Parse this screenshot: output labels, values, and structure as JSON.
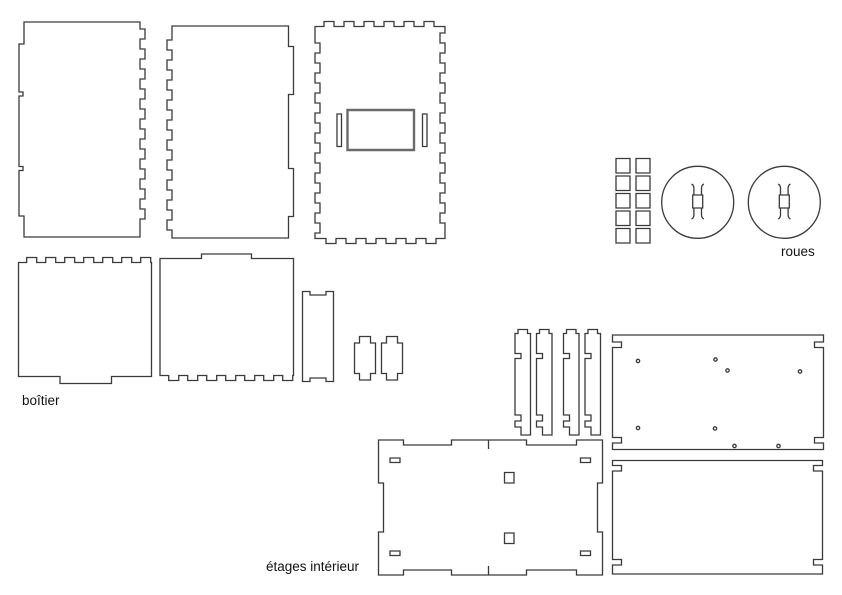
{
  "drawing": {
    "background": "#ffffff",
    "stroke_color": "#3a3a3a",
    "sections": {
      "boitier": {
        "label": "boîtier"
      },
      "roues": {
        "label": "roues"
      },
      "etages_interieur": {
        "label": "étages intérieur"
      }
    }
  },
  "parts": {
    "side_panel_a": {
      "d": "M24,22 H140 v7 h5 v10 h-5 v10 h5 v10 h-5 v10 h5 v10 h-5 v10 h5 v10 h-5 v10 h5 v10 h-5 v10 h5 v10 h-5 v10 h5 v10 h-5 v10 h5 v10 h-5 v10 h5 v10 h-5 v10 h5 v10 h-5 v10 v8 H24 v-21 h-5 v-45.5 h4 v-4 h-4 v-70.5 h4 v-4 h-4 v-48 h5 Z"
    },
    "side_panel_b": {
      "d": "M172,26 H288.5 v20.5 h5 v48 h-5 v74 h5 v48 h-5 v21.5 H172 v-8 h-5 v-10 h5 v-10 h-5 v-10 h5 v-10 h-5 v-10 h5 v-10 h-5 v-10 h5 v-10 h-5 v-10 h5 v-10 h-5 v-10 h5 v-10 h-5 v-10 h5 v-10 h-5 v-10 h5 v-10 h-5 v-10 h5 v-10 h-5 v-10 h5 v-10 v-4 Z"
    },
    "back_panel": {
      "d": "M315,26.5 h9 v-5 h10 v5 h10 v-5 h10 v5 h10 v-5 h10 v5 h10 v-5 h10 v5 h10 v-5 h10 v5 h10 v-5 h10 v5 h11 v6.5 h-5 v10 h5 v10 h-5 v10 h5 v10 h-5 v10 h5 v10 h-5 v10 h5 v10 h-5 v10 h5 v10 h-5 v10 h5 v10 h-5 v10 h5 v10 h-5 v10 h5 v10 h-5 v10 h5 v10 h-5 v10 h5 v10 v5.5 h-9 v5 h-10 v-5 h-10 v5 h-10 v-5 h-10 v5 h-10 v-5 h-10 v5 h-10 v-5 h-10 v5 h-10 v-5 h-10 v5 h-10 v-5 h-11 v-5.5 h5 v-10 h-5 v-10 h5 v-10 h-5 v-10 h5 v-10 h-5 v-10 h5 v-10 h-5 v-10 h5 v-10 h-5 v-10 h5 v-10 h-5 v-10 h5 v-10 h-5 v-10 h5 v-10 h-5 v-10 h5 v-10 h-5 v-10 h5 v-10 h-5 v-10 v-6.5 Z"
    },
    "back_panel_window": {
      "d": "M347.5,110 h66.5 v40 h-66.5 Z"
    },
    "back_panel_slots": {
      "d": "M337,114 h4.5 v32.5 h-4.5 Z M422.5,114 h4.5 v32.5 h-4.5 Z"
    },
    "spacer_squares": {
      "d": "M616,158.5 h14 v14.5 h-14 Z M636,158.5 h14 v14.5 h-14 Z M616,176 h14 v14.5 h-14 Z M636,176 h14 v14.5 h-14 Z M616,193.5 h14 v14.5 h-14 Z M636,193.5 h14 v14.5 h-14 Z M616,211 h14 v14.5 h-14 Z M636,211 h14 v14.5 h-14 Z M616,228.5 h14 v14.5 h-14 Z M636,228.5 h14 v14.5 h-14 Z"
    },
    "wheel_a": {
      "d": "M661.7,202.3 a36,36 0 1 0 72,0 a36,36 0 1 0 -72,0 M692.7,195 h10 v13 h-10 Z M693.9,195 v-7 q0,-2.6 -2.3,-4.1 M701.5,195 v-7 q0,-2.6 2.3,-4.1 M693.9,208 v7 q0,2.6 -2.3,4.1 M701.5,208 v7 q0,2.6 2.3,4.1"
    },
    "wheel_b": {
      "d": "M748.3,202.3 a36,36 0 1 0 72,0 a36,36 0 1 0 -72,0 M779.3,195 h10 v13 h-10 Z M780.5,195 v-7 q0,-2.6 -2.3,-4.1 M788.1,195 v-7 q0,-2.6 2.3,-4.1 M780.5,208 v7 q0,2.6 -2.3,4.1 M788.1,208 v7 q0,2.6 2.3,4.1"
    },
    "box_panel_a": {
      "d": "M18.5,262.5 h8.2 v-5 h10 v5 h9 v-5 h10 v5 h9 v-5 h10 v5 h9 v-5 h10 v5 h9 v-5 h10 v5 h9 v-5 h10 v5 h9 v-5 h10 v5 h0.8 V376.5 h-40 v7 h-51.5 v-7 H18.5 Z"
    },
    "box_panel_b": {
      "d": "M160,258.5 h41.5 v-4.5 h50 v4.5 h42 V375.5 h-0.8 v5 h-10 v-5 h-9 v5 h-10 v-5 h-9 v5 h-10 v-5 h-9 v5 h-10 v-5 h-9 v5 h-10 v-5 h-9 v5 h-10 v-5 h-9 v5 h-10 v-5 h-8.7 Z"
    },
    "box_panel_c": {
      "d": "M302.5,291.5 h7.5 v3.5 h16 v-3.5 h7.5 V381.5 h-7.5 v-3.5 h-16 v3.5 h-7.5 Z"
    },
    "clip_a": {
      "d": "M359.5,336.5 h11 v6.5 h5 v30.5 h-5 v6.5 h-11 v-6.5 h-5 v-30.5 h5 Z"
    },
    "clip_b": {
      "d": "M386.5,336.5 h11 v6.5 h5 v30.5 h-5 v6.5 h-11 v-6.5 h-5 v-30.5 h5 Z"
    },
    "divider_1": {
      "d": "M518,329.5 h9.5 v4 h3 V435 h-9.5 v-8 h-6 v-6 h6 v-6 h-6 V358.5 h6 v-5 h-6 V333.5 h3 Z"
    },
    "divider_2": {
      "d": "M539.5,329.5 h9.5 v4 h3 V435 h-9.5 v-8 h-6 v-6 h6 v-6 h-6 V358.5 h6 v-5 h-6 V333.5 h3 Z"
    },
    "divider_3": {
      "d": "M566.5,329.5 h9.5 v4 h3 V435 h-9.5 v-8 h-6 v-6 h6 v-6 h-6 V358.5 h6 v-5 h-6 V333.5 h3 Z"
    },
    "divider_4": {
      "d": "M588,329.5 h9.5 v4 h3 V435 h-9.5 v-8 h-6 v-6 h6 v-6 h-6 V358.5 h6 v-5 h-6 V333.5 h3 Z"
    },
    "floor_plate": {
      "d": "M378.5,440 H403.5 v5 h48 v-5 H526.5 v5 h50 v-5 H602.5 V483 h-5 v49 h5 V575 H576.5 v-5 h-50 v5 H451.5 v-5 h-48 v5 H378.5 V532 h5 V483 h-5 Z"
    },
    "floor_plate_features": {
      "d": "M488.5,440 v9 M488.5,575 v-9 M390,458 h10 v4.5 h-10 Z M580.5,458 h10 v4.5 h-10 Z M390,551 h10 v4.5 h-10 Z M580.5,551 h10 v4.5 h-10 Z M504.5,472.5 h9.5 v10.5 h-9.5 Z M504.5,533 h9.5 v10.5 h-9.5 Z"
    },
    "shelf_a": {
      "d": "M612.5,335 H823.5 V342 h-9 v5.5 h9 V437.5 h-9 v5.5 h9 V449.5 H612.5 V443 h9 v-5.5 h-9 V347.5 h9 v-5.5 h-9 Z"
    },
    "shelf_a_holes": {
      "d": "M636.3,361 a1.7,1.7 0 1 0 3.4,0 a1.7,1.7 0 1 0 -3.4,0 M713.8,359.5 a1.7,1.7 0 1 0 3.4,0 a1.7,1.7 0 1 0 -3.4,0 M725.8,370.5 a1.7,1.7 0 1 0 3.4,0 a1.7,1.7 0 1 0 -3.4,0 M798.3,371.5 a1.7,1.7 0 1 0 3.4,0 a1.7,1.7 0 1 0 -3.4,0 M636.3,428 a1.7,1.7 0 1 0 3.4,0 a1.7,1.7 0 1 0 -3.4,0 M713.3,428.5 a1.7,1.7 0 1 0 3.4,0 a1.7,1.7 0 1 0 -3.4,0 M732.8,446 a1.7,1.7 0 1 0 3.4,0 a1.7,1.7 0 1 0 -3.4,0 M776.8,446 a1.7,1.7 0 1 0 3.4,0 a1.7,1.7 0 1 0 -3.4,0"
    },
    "shelf_b": {
      "d": "M612.5,460.5 H822.5 V465.5 h-9 v5.5 h9 V559.5 h-9 v5.5 h9 V574 H612.5 V565 h9 v-5.5 h-9 V471 h9 v-5.5 h-9 Z"
    }
  }
}
